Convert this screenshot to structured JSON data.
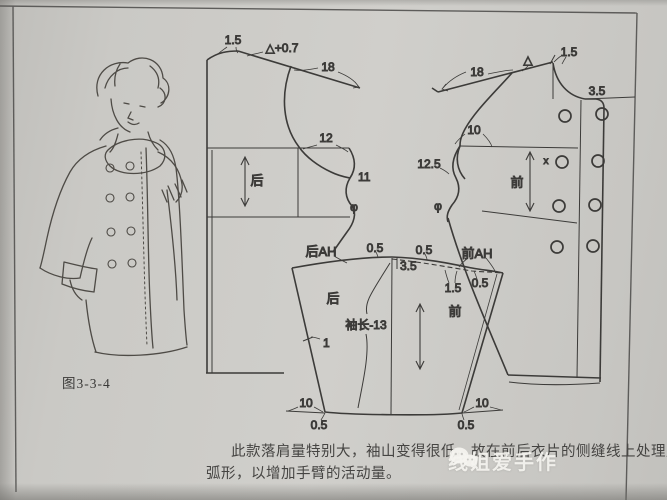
{
  "page": {
    "caption": "图3-3-4",
    "paragraph_line1": "此款落肩量特别大，袖山变得很低，故在前后衣片的侧缝线上处理成",
    "paragraph_line2": "弧形，以增加手臂的活动量。",
    "watermark": "线姐爱手作",
    "watermark_icon": "wechat-icon"
  },
  "colors": {
    "paper": "#c9c8c4",
    "ink": "#3c3b39",
    "watermark": "#f3f2ee"
  },
  "back_piece": {
    "label": "后",
    "neck_rise": "1.5",
    "shoulder_drop": "△+0.7",
    "shoulder_extension": "18",
    "chest_note": "12",
    "side_note": "11",
    "match_mark": "φ"
  },
  "front_piece": {
    "label": "前",
    "shoulder_extension": "18",
    "shoulder_mark": "△",
    "neck_rise": "1.5",
    "front_edge_width": "3.5",
    "armhole_note": "10",
    "side_note": "12.5",
    "match_mark": "φ",
    "button_mark": "x"
  },
  "sleeve": {
    "back_label": "后",
    "front_label": "前",
    "back_cap_label": "后AH",
    "front_cap_label": "前AH",
    "cap_notch_back": "0.5",
    "cap_notch_front": "0.5",
    "cap_drop": "3.5",
    "front_ease_a": "1.5",
    "front_ease_b": "0.5",
    "length_formula": "袖长-13",
    "seam_note": "1",
    "hem_inset_back": "10",
    "hem_inset_front": "10",
    "hem_drop_back": "0.5",
    "hem_drop_front": "0.5"
  }
}
